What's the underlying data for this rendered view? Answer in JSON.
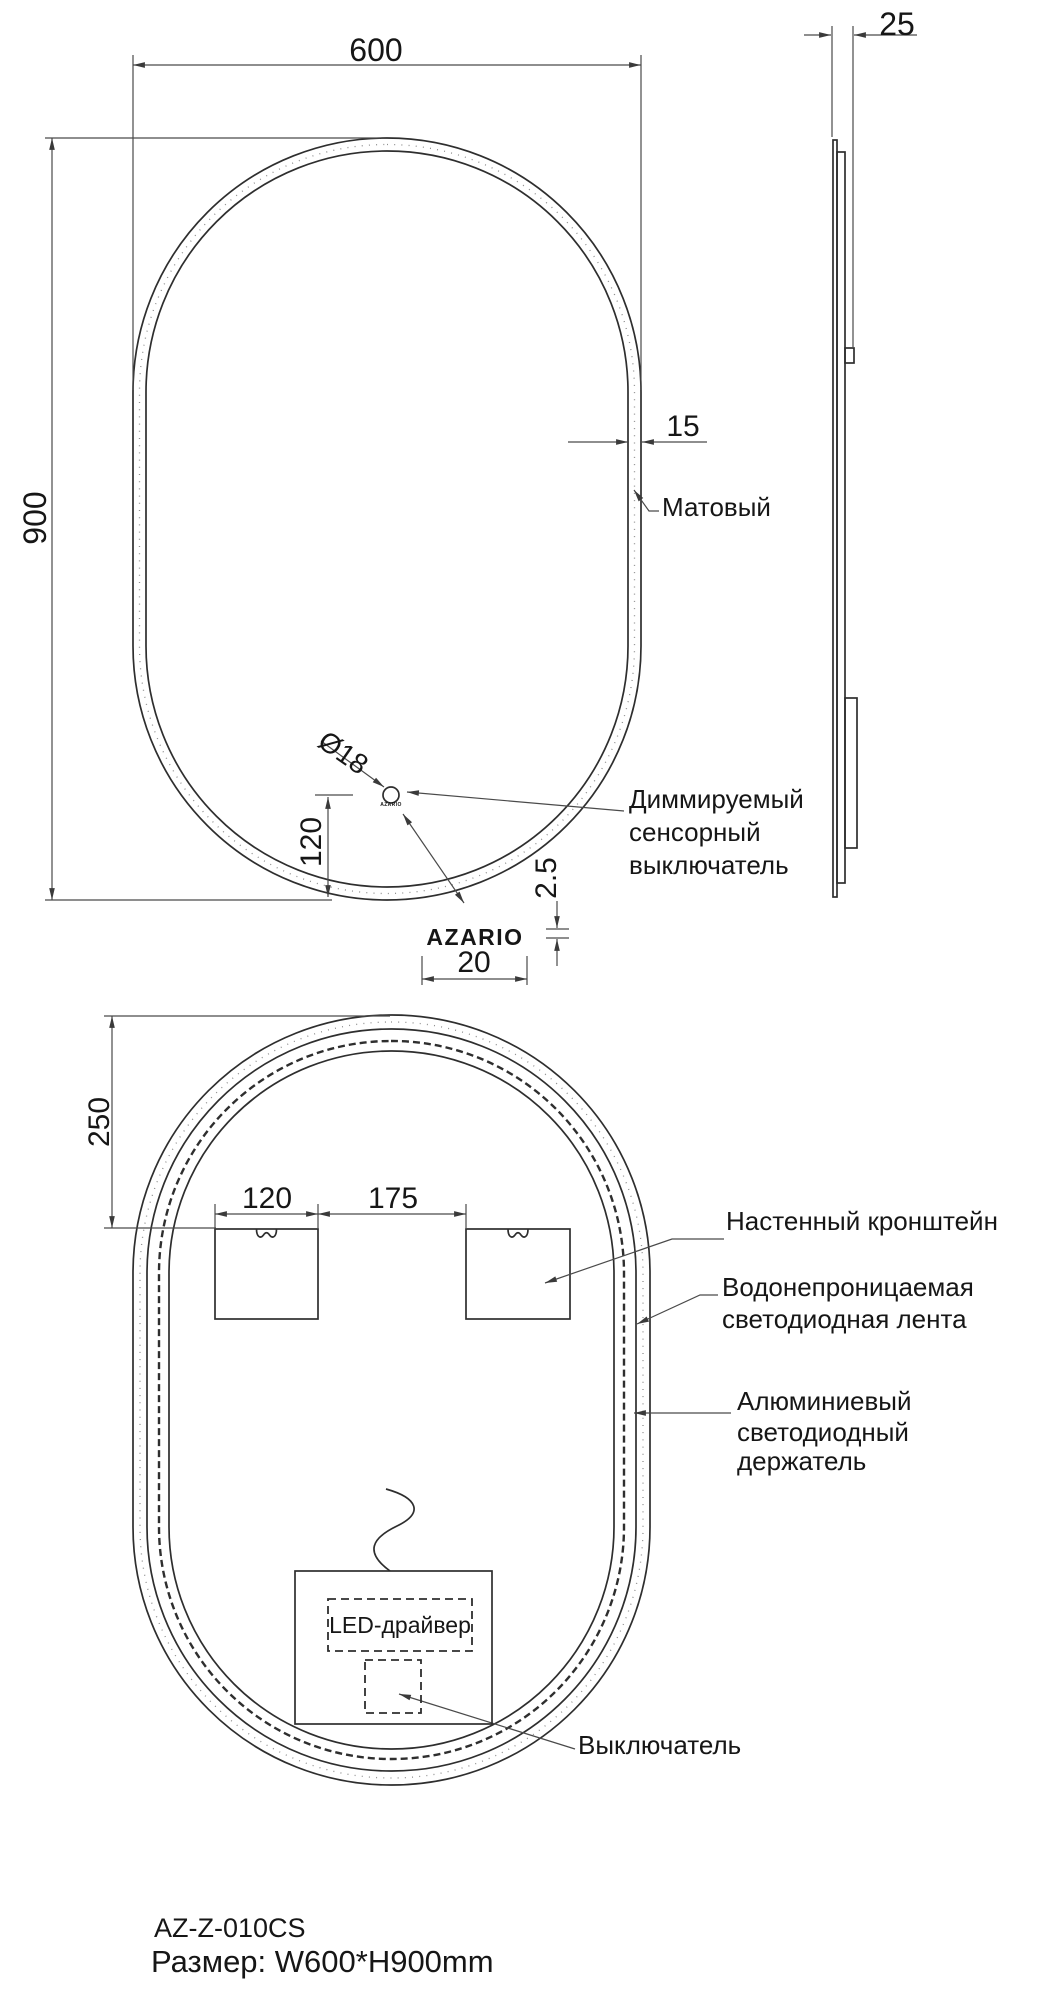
{
  "colors": {
    "line": "#2e2e2e",
    "dim": "#4a4a4a",
    "text": "#161616",
    "background": "#ffffff"
  },
  "front_view": {
    "dim_width": "600",
    "dim_height": "900",
    "dim_edge": "15",
    "dim_sensor_diameter": "Ø18",
    "dim_sensor_offset": "120",
    "dim_logo_height": "2.5",
    "dim_logo_width": "20",
    "label_matte": "Матовый",
    "label_dimmable_line1": "Диммируемый",
    "label_dimmable_line2": "сенсорный",
    "label_dimmable_line3": "выключатель",
    "logo_small": "AZARIO",
    "logo_large": "AZARIO"
  },
  "side_view": {
    "dim_depth": "25"
  },
  "back_view": {
    "dim_top_offset": "250",
    "dim_bracket_width": "120",
    "dim_bracket_gap": "175",
    "label_bracket": "Настенный кронштейн",
    "label_led_line1": "Водонепроницаемая",
    "label_led_line2": "светодиодная лента",
    "label_holder_line1": "Алюминиевый",
    "label_holder_line2": "светодиодный",
    "label_holder_line3": "держатель",
    "label_driver": "LED-драйвер",
    "label_switch": "Выключатель"
  },
  "footer": {
    "model": "AZ-Z-010CS",
    "size": "Размер: W600*H900mm"
  }
}
